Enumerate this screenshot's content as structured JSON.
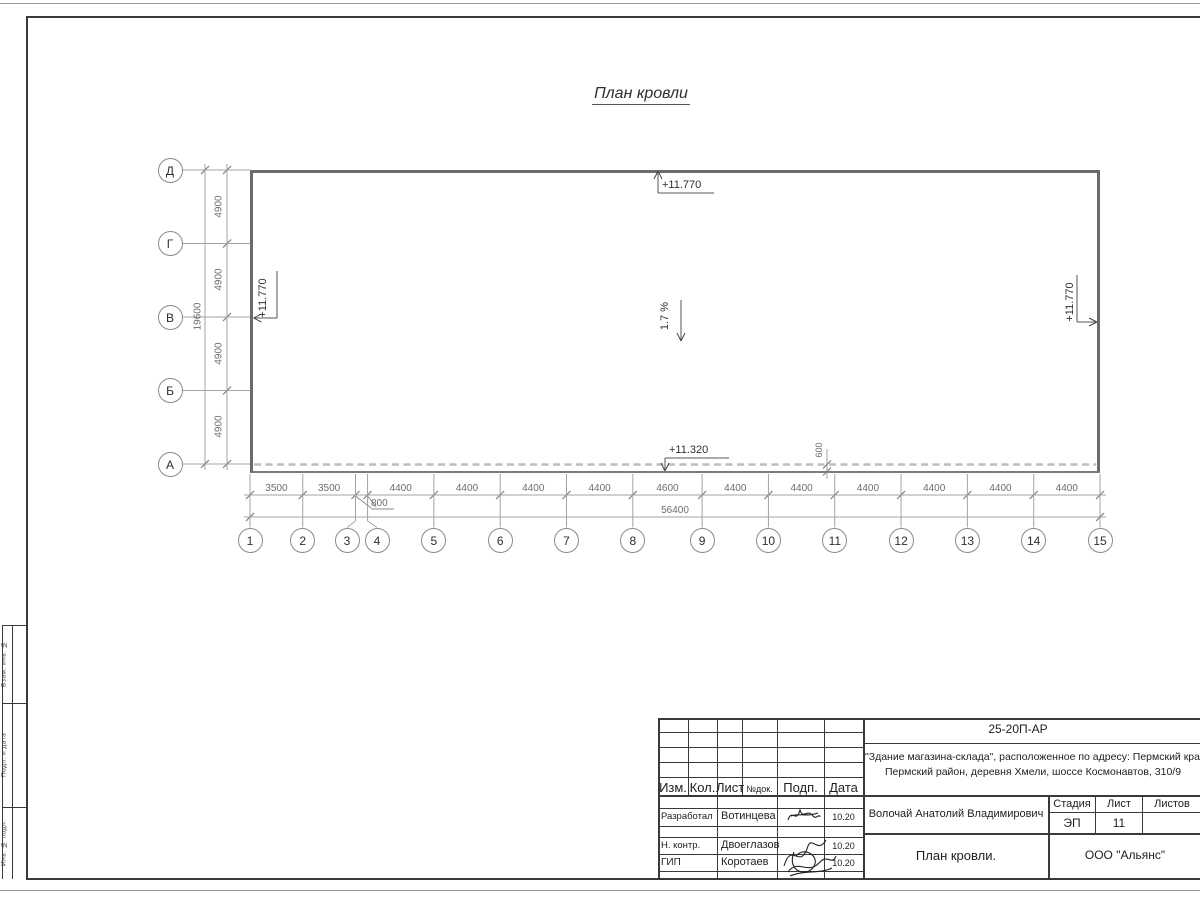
{
  "plan": {
    "title": "План кровли",
    "cols": {
      "labels": [
        "1",
        "2",
        "3",
        "4",
        "5",
        "6",
        "7",
        "8",
        "9",
        "10",
        "11",
        "12",
        "13",
        "14",
        "15"
      ],
      "positions_mm": [
        0,
        3500,
        7000,
        7800,
        12200,
        16600,
        21000,
        25400,
        30000,
        34400,
        38800,
        43200,
        47600,
        52000,
        56400
      ],
      "segment_dims": [
        "3500",
        "3500",
        "800",
        "4400",
        "4400",
        "4400",
        "4400",
        "4600",
        "4400",
        "4400",
        "4400",
        "4400",
        "4400",
        "4400"
      ],
      "total_dim": "56400",
      "callout_dim": "800"
    },
    "rows": {
      "labels": [
        "Д",
        "Г",
        "В",
        "Б",
        "А"
      ],
      "positions_mm": [
        0,
        4900,
        9800,
        14700,
        19600
      ],
      "segment_dims": [
        "4900",
        "4900",
        "4900",
        "4900"
      ],
      "total_dim": "19600"
    },
    "annotations": {
      "elev_top": "+11.770",
      "elev_left": "+11.770",
      "elev_right": "+11.770",
      "elev_bottom": "+11.320",
      "slope": "1.7 %",
      "parapet_dim": "600"
    }
  },
  "title_block": {
    "doc_number": "25-20П-АР",
    "object_line1": "\"Здание магазина-склада\", расположенное по адресу: Пермский край,",
    "object_line2": "Пермский район, деревня Хмели, шоссе Космонавтов, 310/9",
    "header_cols": {
      "izm": "Изм.",
      "kol": "Кол.",
      "list": "Лист",
      "ndok": "№док.",
      "podp": "Подп.",
      "data": "Дата"
    },
    "rows": [
      {
        "role": "Разработал",
        "name": "Вотинцева",
        "date": "10.20"
      },
      {
        "role": "Н. контр.",
        "name": "Двоеглазов",
        "date": "10.20"
      },
      {
        "role": "ГИП",
        "name": "Коротаев",
        "date": "10.20"
      }
    ],
    "chief_name": "Волочай Анатолий Владимирович",
    "sheet_title": "План кровли.",
    "stage_label": "Стадия",
    "sheet_label": "Лист",
    "sheets_label": "Листов",
    "stage_value": "ЭП",
    "sheet_value": "11",
    "sheets_value": "",
    "company": "ООО \"Альянс\""
  },
  "side_stamp": {
    "box1": "Взам. инв. №",
    "box2": "Подп. и дата",
    "box3": "Инв. № подл."
  }
}
